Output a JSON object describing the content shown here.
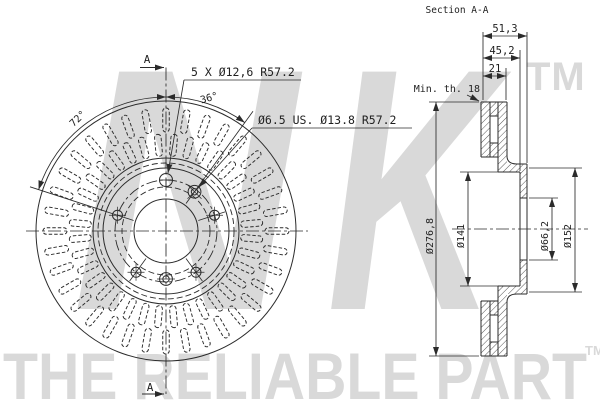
{
  "watermark": {
    "brand_letter_1": "N",
    "brand_letter_2": "K",
    "trademark": "TM",
    "tagline": "THE RELIABLE PART",
    "tagline_trademark": "TM",
    "color": "#d9d9d9"
  },
  "disc_view": {
    "section_marker_top": "A",
    "section_marker_bottom": "A",
    "bolt_pattern_label": "5 X Ø12,6  R57.2",
    "pin_hole_label": "Ø6.5 US. Ø13.8  R57.2",
    "angle_to_pin_hole": "36°",
    "angle_between_bolts": "72°"
  },
  "section_view": {
    "title": "Section A-A",
    "overall_width": "51,3",
    "hub_width": "45,2",
    "ring_thickness": "21",
    "min_thickness": "Min. th. 18",
    "outer_diameter": "Ø276,8",
    "hat_diameter": "Ø141",
    "bore_diameter": "Ø66,2",
    "flange_diameter": "Ø152"
  },
  "drawing": {
    "line_color": "#2b2b2b",
    "disc": {
      "center": [
        166,
        231
      ],
      "slot_bands": [
        {
          "count": 36,
          "offset_deg": 0,
          "r_inner": 99,
          "r_outer": 123,
          "width": 6.5
        },
        {
          "count": 36,
          "offset_deg": 5,
          "r_inner": 75,
          "r_outer": 97,
          "width": 6.5
        }
      ],
      "bolt_holes": {
        "circle_r": 51,
        "hole_r": 5,
        "top_hole_r": 6.5,
        "angles_deg": [
          90,
          162,
          18,
          234,
          306
        ]
      },
      "small_holes": [
        {
          "angle_deg": 54,
          "radius": 48.5,
          "cross": "diagonal"
        },
        {
          "angle_deg": 270,
          "radius": 48,
          "cross": "orthogonal"
        }
      ]
    }
  }
}
